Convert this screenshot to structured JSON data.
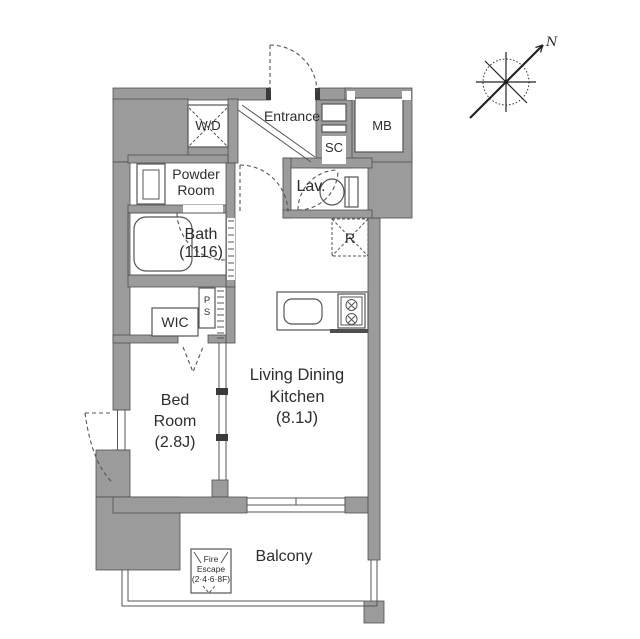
{
  "colors": {
    "wall": "#9b9b9b",
    "outline": "#4f4f4f",
    "line": "#555555",
    "text": "#2d2d2d",
    "background": "#ffffff"
  },
  "compass": {
    "north_label": "N"
  },
  "rooms": {
    "entrance": {
      "label": "Entrance"
    },
    "shoe_closet": {
      "label": "SC"
    },
    "meter_box": {
      "label": "MB"
    },
    "lavatory": {
      "label": "Lav."
    },
    "refrigerator_space": {
      "label": "R"
    },
    "washer_dryer": {
      "label": "W/D"
    },
    "powder_room": {
      "line1": "Powder",
      "line2": "Room"
    },
    "bath": {
      "line1": "Bath",
      "line2": "(1116)"
    },
    "wic": {
      "label": "WIC"
    },
    "pipe_space": {
      "line1": "P",
      "line2": "S"
    },
    "bedroom": {
      "line1": "Bed",
      "line2": "Room",
      "line3": "(2.8J)"
    },
    "living_dining_kitchen": {
      "line1": "Living Dining",
      "line2": "Kitchen",
      "line3": "(8.1J)"
    },
    "balcony": {
      "label": "Balcony"
    },
    "fire_escape": {
      "line1": "Fire",
      "line2": "Escape",
      "line3": "(2·4·6·8F)"
    }
  }
}
